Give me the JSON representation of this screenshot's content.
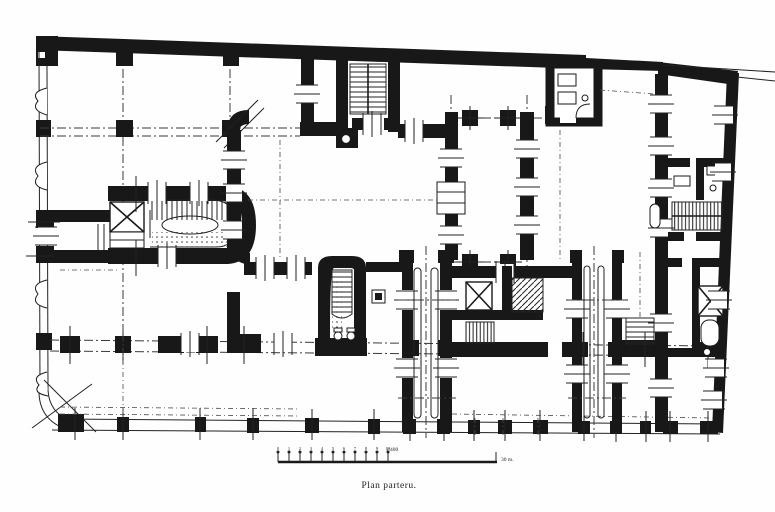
{
  "caption": {
    "title": "Plan parteru."
  },
  "scalebar": {
    "ratio": "1:400",
    "end_label": "30 m.",
    "tick_labels": [
      "0",
      "1",
      "2",
      "3",
      "4",
      "5",
      "6",
      "7",
      "8",
      "9",
      "10"
    ]
  },
  "drawing": {
    "kind": "ground-floor architectural plan",
    "ink_color": "#181818",
    "paper_color": "#fefefe"
  }
}
